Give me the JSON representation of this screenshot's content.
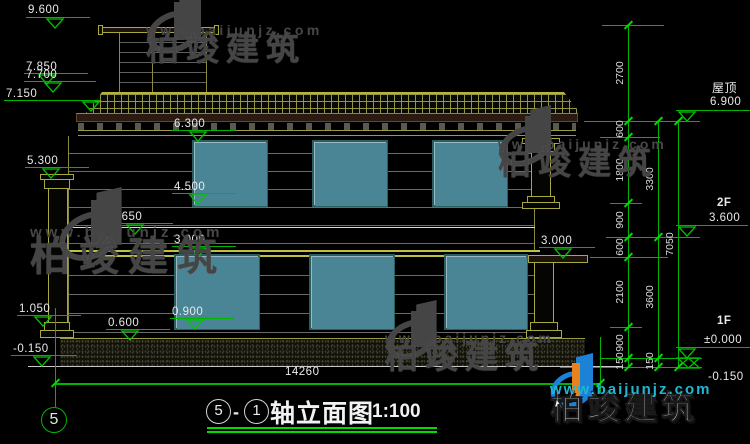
{
  "watermark": {
    "brand": "柏竣建筑",
    "url": "www.baijunjz.com"
  },
  "title": {
    "b1": "5",
    "sep": "-",
    "b2": "1",
    "name": "轴立面图",
    "scale": "1:100"
  },
  "bottom": {
    "overall": "14260",
    "axis": "5"
  },
  "left_markers": [
    "9.600",
    "7.850",
    "7.700",
    "7.150",
    "5.300",
    "3.650",
    "1.050",
    "0.600",
    "0.900",
    "-0.150"
  ],
  "inner_markers": [
    "6.300",
    "4.500",
    "3.000",
    "3.000"
  ],
  "right_levels": [
    {
      "label": "屋顶",
      "value": "6.900"
    },
    {
      "label": "2F",
      "value": "3.600"
    },
    {
      "label": "1F",
      "value": "±0.000"
    },
    {
      "label": "",
      "value": "-0.150"
    }
  ],
  "chains": {
    "c1": [
      "2700",
      "600",
      "1800",
      "900",
      "600",
      "2100",
      "900",
      "150"
    ],
    "c2": [
      "3300",
      "3600",
      "150"
    ],
    "c3": [
      "7050"
    ]
  },
  "colors": {
    "dim_green": "#00c800",
    "text_white": "#e9e9e9",
    "outline_olive": "#8a8a3a",
    "slab_yellow": "#c0c040",
    "window_teal": "#4a8596",
    "watermark_grey": "#454545",
    "logo_blue": "#1b82d8",
    "logo_orange": "#e8821e",
    "url_teal": "#20b6d4"
  }
}
